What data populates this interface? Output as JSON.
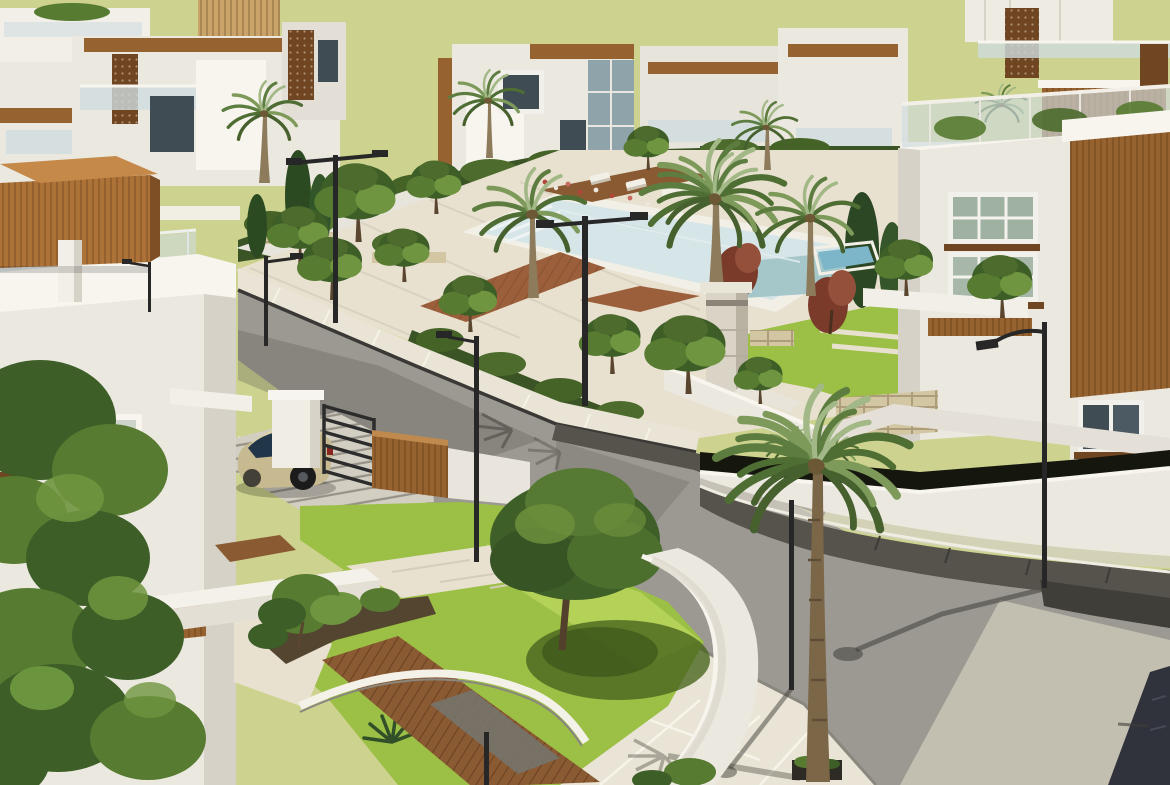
{
  "meta": {
    "title": "Aerial 3D architectural rendering of a modern residential villa community",
    "image_type": "3d-render",
    "width_px": 1170,
    "height_px": 785
  },
  "palette": {
    "sky": "#cdd28e",
    "wall_light": "#ebe8e0",
    "wall_bright": "#f7f5ee",
    "wall_shadow": "#d7d2c7",
    "wood": "#96622f",
    "wood_light": "#c08a4e",
    "wood_dark": "#6f4522",
    "wood_deck": "#8a5a33",
    "pergola": "#ad7238",
    "glass": "#cfdce0",
    "window_dark": "#3f4c54",
    "lawn": "#9cbf45",
    "lawn_bright": "#b8d35c",
    "tree_dark": "#3e5e27",
    "tree_mid": "#567b31",
    "tree_light": "#6f9540",
    "palm_pale": "#a3b887",
    "palm_green": "#6f8c4f",
    "hedge": "#3b5425",
    "road": "#9c9992",
    "road_light": "#c9c4b5",
    "sidewalk": "#e9e4d5",
    "paving": "#e8e1d0",
    "curb_dark": "#3a3936",
    "paver_dark": "#55534b",
    "stone": "#d3c6a3",
    "pillar": "#d9d4c6",
    "water": "#d6e5e7",
    "water_deep": "#a6c7ca",
    "pool_blue": "#7db6c8",
    "car_body": "#c7ba91",
    "car_glass": "#22364a",
    "metal": "#272727",
    "maroon": "#7b3b2b",
    "trunk": "#8d7b5c",
    "soil": "#53452f",
    "sign_dark": "#30323c"
  },
  "scene": {
    "description": "Sunlit render of a gated villa compound: rows of white flat-roofed villas with timber fascias, perforated wood screens and glass balcony railings; a central landscaped park with a pale-blue swimming pool, sun loungers, timber decks, stone planters and palm trees; curving asphalt streets with paved sidewalks and black street lamps; a beige hatchback parked behind a black gate beside a timber fence; lush front gardens with lawns, stone paths, a timber slat walkway and a curved white boundary wall.",
    "sky": {
      "color_key": "sky"
    },
    "elements": [
      {
        "name": "background-villas",
        "style": "white modern villas, timber fascias, glass railings, perforated timber screens"
      },
      {
        "name": "community-park",
        "features": [
          "swimming pool",
          "sun loungers",
          "timber deck",
          "stone planter walls",
          "clipped hedges",
          "flower beds",
          "stone pillar"
        ]
      },
      {
        "name": "streets",
        "features": [
          "asphalt road",
          "paved sidewalks",
          "dark paver gutters",
          "cast shadows"
        ]
      },
      {
        "name": "right-villa",
        "features": [
          "vertical timber cladding",
          "two window bands with timber sills",
          "rooftop glass railing",
          "curved boundary wall",
          "private blue pool"
        ]
      },
      {
        "name": "left-villa",
        "features": [
          "rooftop glass railing",
          "timber pergola",
          "window with timber sill",
          "horizontal timber band"
        ]
      },
      {
        "name": "driveway",
        "features": [
          "striped paving",
          "white gate pillar",
          "black metal gate",
          "timber fence",
          "parked beige hatchback"
        ]
      },
      {
        "name": "front-garden",
        "features": [
          "lawn",
          "stone paths",
          "timber slat walkway",
          "curved white wall",
          "large shade tree",
          "agave"
        ]
      },
      {
        "name": "street-lamps",
        "count": 8
      },
      {
        "name": "palm-trees",
        "count": 9
      },
      {
        "name": "parked-car",
        "color_key": "car_body",
        "type": "hatchback"
      }
    ]
  }
}
